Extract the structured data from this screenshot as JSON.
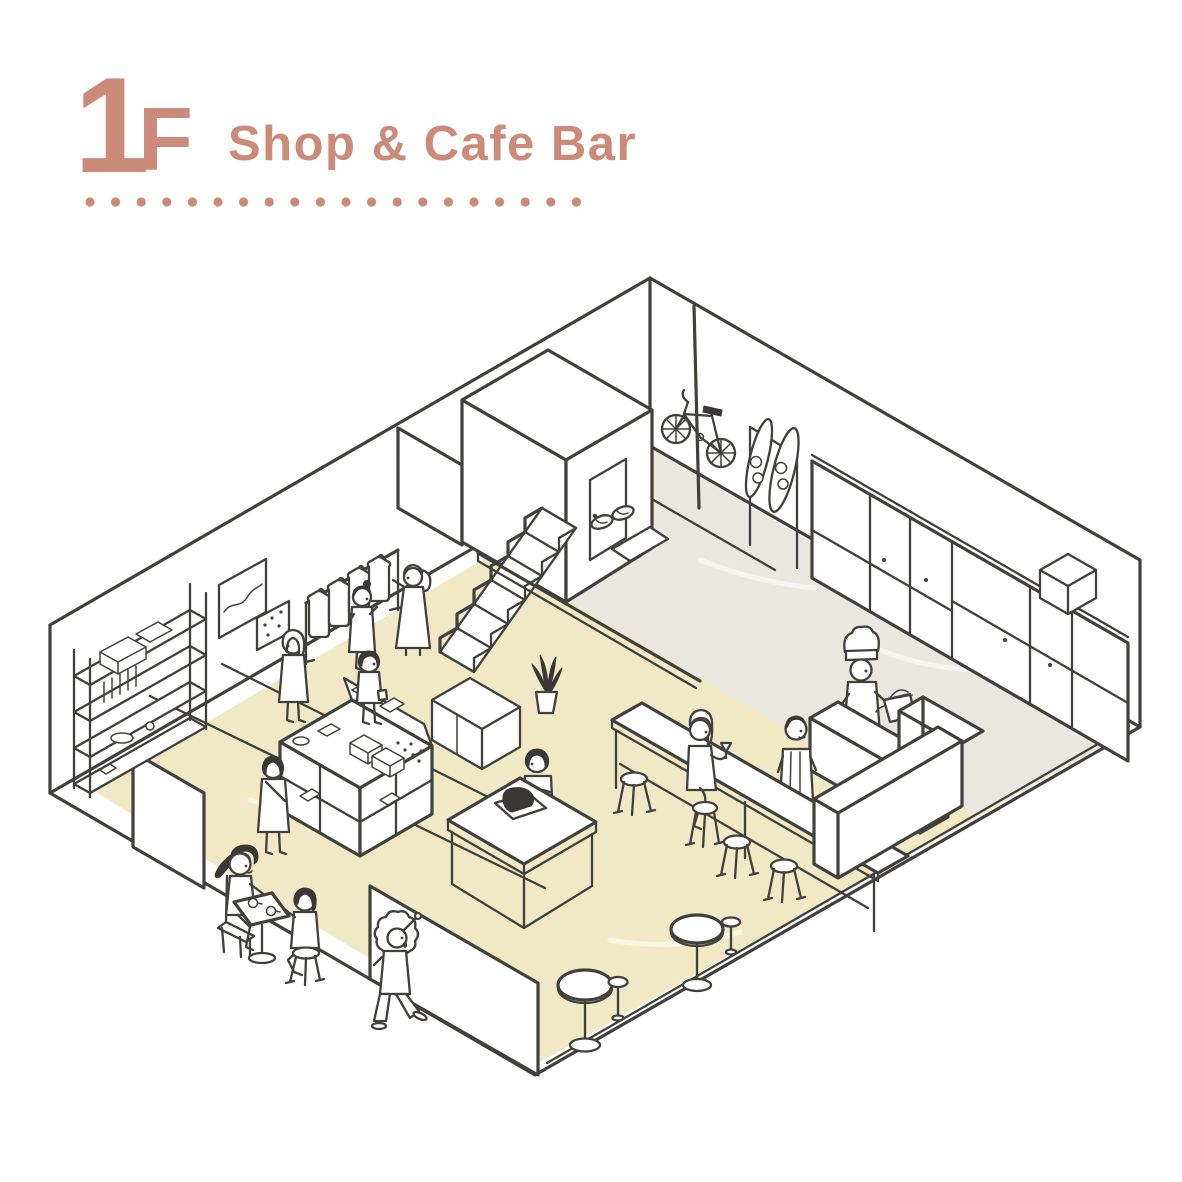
{
  "header": {
    "floor_number": "1",
    "floor_letter": "F",
    "title": "Shop & Cafe Bar"
  },
  "theme": {
    "accent": "#cb8b78",
    "ink": "#41403c",
    "hair": "#3a3834",
    "floor_yellow": "#f1e9c5",
    "floor_gray": "#e9e7e0",
    "paper": "#ffffff"
  },
  "illustration": {
    "type": "isometric-floorplan",
    "floor": "1F",
    "areas": [
      "shop",
      "cafe bar",
      "kitchen",
      "staircase",
      "raised platform",
      "entrance"
    ],
    "objects": [
      "display-shelf",
      "wall-art-frames",
      "clothes-rack",
      "display-table",
      "storage-cabinet",
      "potted-plant",
      "staircase",
      "storage-room",
      "support-pole",
      "hanging-bicycle",
      "snowboards",
      "slippers",
      "floor-mat",
      "kitchen-cabinets",
      "kitchen-island",
      "kettle",
      "bar-table",
      "bar-stools",
      "bar-counter",
      "work-table",
      "laptop",
      "cafe-table",
      "cafe-chair",
      "cafe-stool",
      "round-tables",
      "small-stools"
    ],
    "people": [
      "woman-browsing-clothes-rack",
      "woman-with-hat-at-rack",
      "blonde-woman-walking",
      "boy-with-shopping-bag",
      "woman-with-crossbody-bag",
      "boy-at-work-table",
      "woman-on-bar-stool",
      "bartender",
      "chef-with-kettle",
      "woman-with-ponytail-at-cafe-table",
      "woman-with-bob-at-cafe-table",
      "child-walking"
    ],
    "people_count": 12
  }
}
